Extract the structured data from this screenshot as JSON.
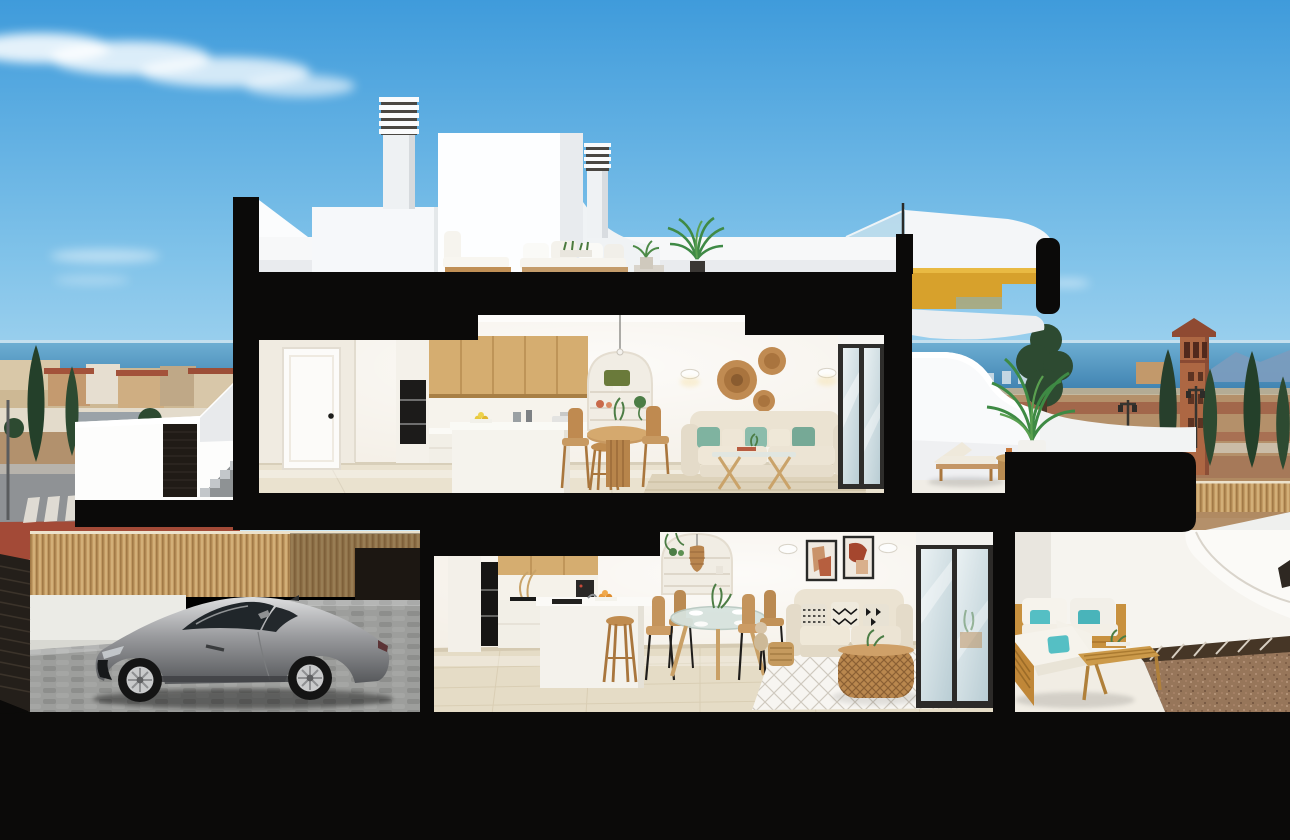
{
  "scene": {
    "type": "3d-architectural-cutaway-render",
    "subject": "two-storey coastal townhouse cross-section with roof terrace, furnished interiors, garage driveway with silver sports car, sea and town backdrop",
    "floors": [
      "roof-terrace",
      "upper-floor",
      "ground-floor"
    ],
    "rooms_visible": [
      "rooftop-lounge",
      "upper-kitchen",
      "upper-dining",
      "upper-living",
      "upper-terrace",
      "ground-kitchen",
      "ground-dining",
      "ground-living",
      "ground-terrace",
      "garage-driveway"
    ],
    "background_elements": [
      "sky",
      "clouds",
      "sea",
      "mountains",
      "distant-town",
      "watchtower",
      "cypress-trees",
      "street",
      "dirt-field",
      "bamboo-fence"
    ]
  },
  "palette": {
    "sky_top": "#3f9bdb",
    "sky_mid": "#7fc2e9",
    "sky_horizon": "#d6edf8",
    "sea": "#4b90be",
    "mountain": "#7a9cbe",
    "field_tan": "#b4906a",
    "path_red": "#9e5c44",
    "town_tan": "#cdb894",
    "roof_red": "#a3523a",
    "tree_dark": "#2d4a31",
    "tree_mid": "#49703f",
    "cut_black": "#0b0a09",
    "wall_white": "#f7f8f9",
    "parapet_shade": "#e2e6e9",
    "interior_wall": "#f4efe6",
    "floor_tile_upper": "#eae2cf",
    "floor_tile_lower": "#e5dcc6",
    "wood_cabinet": "#d5ad70",
    "wood_furniture": "#c08f55",
    "wood_outdoor": "#c8913f",
    "gold_stair": "#d7a12c",
    "sofa_cream": "#ebe3d2",
    "pillow_teal": "#55bfc4",
    "pillow_green": "#7fb3a0",
    "rattan": "#b9874e",
    "rug_beige": "#ddd2ba",
    "glass_blue": "#cfe4ee",
    "car_silver": "#a8aaac",
    "driveway_gray": "#9d9e9c",
    "bamboo_fence": "#c29a63",
    "gate_dark": "#201b16",
    "gravel_brown": "#97765a",
    "street_asphalt": "#8f9295",
    "sidewalk_red": "#a34a37",
    "concrete": "#bfc3c6",
    "tower_brick": "#ad6743"
  }
}
